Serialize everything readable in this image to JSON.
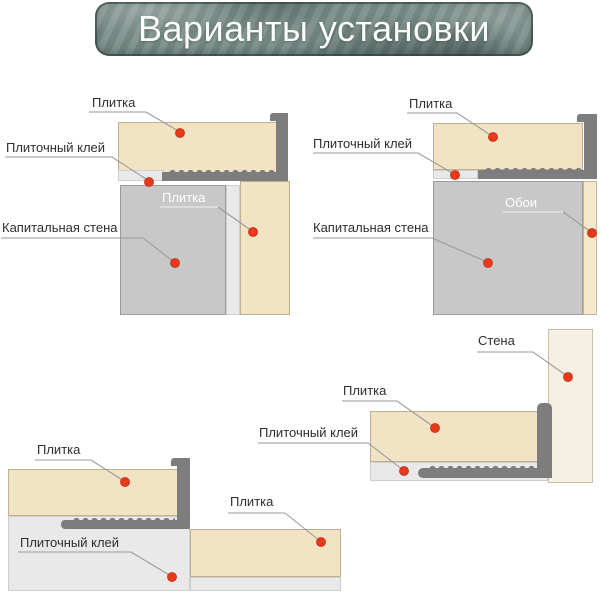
{
  "title": "Варианты установки",
  "colors": {
    "banner": "#7d918c",
    "tile": "#f2e3c4",
    "adhesive": "#e9e9e9",
    "main_wall": "#c8c8c8",
    "light_wall": "#f5f0e1",
    "wallpaper": "#f3e8cc",
    "trim_profile": "#7d7d7d",
    "marker_dot": "#e8391d",
    "leader_line": "#9a9a9a",
    "label_text": "#2e2e2e"
  },
  "diagrams": {
    "top_left": {
      "tile_top": "Плитка",
      "tile_adhesive": "Плиточный клей",
      "main_wall": "Капитальная стена",
      "tile_side": "Плитка"
    },
    "top_right": {
      "tile": "Плитка",
      "tile_adhesive": "Плиточный клей",
      "main_wall": "Капитальная стена",
      "wallpaper": "Обои"
    },
    "bottom_left": {
      "tile_upper": "Плитка",
      "tile_adhesive": "Плиточный клей",
      "tile_lower": "Плитка"
    },
    "bottom_right": {
      "wall": "Стена",
      "tile": "Плитка",
      "tile_adhesive": "Плиточный клей"
    }
  }
}
